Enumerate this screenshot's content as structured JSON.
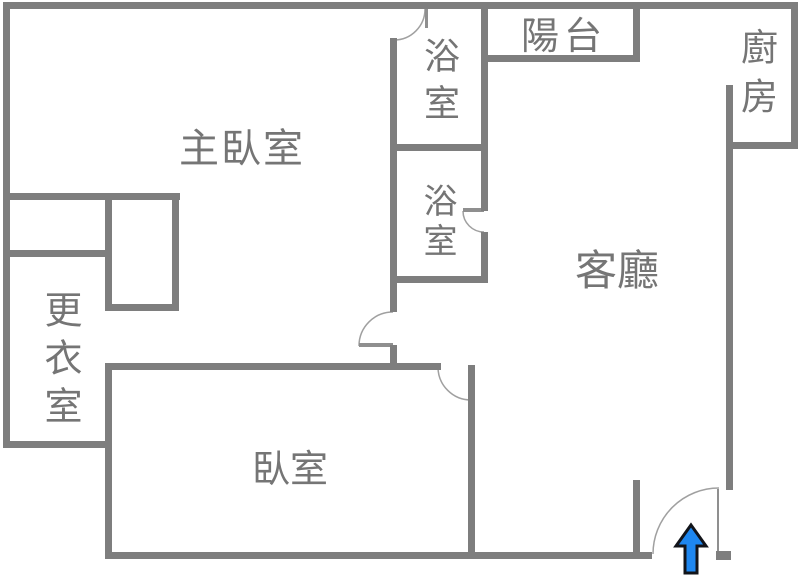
{
  "title": "apartment-floor-plan",
  "canvas": {
    "width": 800,
    "height": 576
  },
  "colors": {
    "background": "#ffffff",
    "wall": "#7e7e7e",
    "label": "#757575",
    "door_arc": "#a0a0a0",
    "door_leaf": "#8f8f8f",
    "arrow_fill": "#1e87f0",
    "arrow_stroke": "#12141a"
  },
  "rooms": [
    {
      "name": "master-bedroom",
      "text": "主臥室",
      "x": 242,
      "y": 149,
      "orientation": "horizontal",
      "font_size": 40,
      "letter_spacing": 2
    },
    {
      "name": "bathroom-top",
      "text": "浴室",
      "x": 438,
      "y": 84,
      "orientation": "vertical",
      "font_size": 36,
      "letter_spacing": 11
    },
    {
      "name": "bathroom-mid",
      "text": "浴室",
      "x": 437,
      "y": 223,
      "orientation": "vertical",
      "font_size": 34,
      "letter_spacing": 6
    },
    {
      "name": "balcony",
      "text": "陽台",
      "x": 564,
      "y": 36,
      "orientation": "horizontal",
      "font_size": 38,
      "letter_spacing": 5
    },
    {
      "name": "kitchen",
      "text": "廚房",
      "x": 756,
      "y": 77,
      "orientation": "vertical",
      "font_size": 37,
      "letter_spacing": 12
    },
    {
      "name": "living-room",
      "text": "客廳",
      "x": 617,
      "y": 271,
      "orientation": "horizontal",
      "font_size": 42,
      "letter_spacing": 0
    },
    {
      "name": "dressing-room",
      "text": "更衣室",
      "x": 60,
      "y": 362,
      "orientation": "vertical",
      "font_size": 38,
      "letter_spacing": 10
    },
    {
      "name": "bedroom",
      "text": "臥室",
      "x": 290,
      "y": 469,
      "orientation": "horizontal",
      "font_size": 38,
      "letter_spacing": 0
    }
  ],
  "walls": [
    {
      "name": "outer-top",
      "x": 3,
      "y": 2,
      "w": 795,
      "h": 7
    },
    {
      "name": "outer-left",
      "x": 3,
      "y": 2,
      "w": 7,
      "h": 446
    },
    {
      "name": "outer-right",
      "x": 791,
      "y": 2,
      "w": 7,
      "h": 147
    },
    {
      "name": "kitchen-bottom",
      "x": 726,
      "y": 142,
      "w": 72,
      "h": 7
    },
    {
      "name": "kitchen-left-long",
      "x": 726,
      "y": 85,
      "w": 7,
      "h": 405
    },
    {
      "name": "bath-right-upper",
      "x": 481,
      "y": 2,
      "w": 7,
      "h": 209
    },
    {
      "name": "bath-right-lower",
      "x": 481,
      "y": 232,
      "w": 7,
      "h": 51
    },
    {
      "name": "balcony-bottom",
      "x": 481,
      "y": 55,
      "w": 159,
      "h": 7
    },
    {
      "name": "balcony-right",
      "x": 633,
      "y": 2,
      "w": 7,
      "h": 60
    },
    {
      "name": "bath-divider",
      "x": 390,
      "y": 144,
      "w": 98,
      "h": 7
    },
    {
      "name": "bath-left",
      "x": 390,
      "y": 38,
      "w": 7,
      "h": 274
    },
    {
      "name": "corridor-stub",
      "x": 390,
      "y": 345,
      "w": 7,
      "h": 25
    },
    {
      "name": "bath-mid-bottom",
      "x": 390,
      "y": 276,
      "w": 98,
      "h": 7
    },
    {
      "name": "bedroom-top",
      "x": 105,
      "y": 363,
      "w": 336,
      "h": 7
    },
    {
      "name": "bedroom-left",
      "x": 105,
      "y": 363,
      "w": 7,
      "h": 196
    },
    {
      "name": "bedroom-right",
      "x": 468,
      "y": 365,
      "w": 7,
      "h": 194
    },
    {
      "name": "outer-bottom",
      "x": 105,
      "y": 552,
      "w": 547,
      "h": 7
    },
    {
      "name": "entry-stub",
      "x": 633,
      "y": 480,
      "w": 7,
      "h": 79
    },
    {
      "name": "entry-jamb",
      "x": 716,
      "y": 551,
      "w": 15,
      "h": 9
    },
    {
      "name": "master-divider",
      "x": 3,
      "y": 193,
      "w": 177,
      "h": 7
    },
    {
      "name": "closet-mid",
      "x": 105,
      "y": 193,
      "w": 7,
      "h": 118
    },
    {
      "name": "closet-right",
      "x": 172,
      "y": 193,
      "w": 7,
      "h": 118
    },
    {
      "name": "closet-shelf",
      "x": 3,
      "y": 250,
      "w": 109,
      "h": 7
    },
    {
      "name": "closet-bottom",
      "x": 105,
      "y": 304,
      "w": 74,
      "h": 7
    },
    {
      "name": "dressing-bottom",
      "x": 3,
      "y": 441,
      "w": 109,
      "h": 7
    }
  ],
  "doors": [
    {
      "name": "door-bathroom-top",
      "arc": "M425,9 A31,31 0 0 1 394,40",
      "leaf": {
        "x": 425,
        "y": 9,
        "w": 3,
        "h": 19
      }
    },
    {
      "name": "door-bathroom-mid",
      "arc": "M463,211 A21,21 0 0 0 484,232",
      "leaf": {
        "x": 463,
        "y": 208,
        "w": 21,
        "h": 4
      }
    },
    {
      "name": "door-master-suite",
      "arc": "M359,346 A34,34 0 0 1 393,312",
      "leaf": {
        "x": 359,
        "y": 343,
        "w": 34,
        "h": 4
      }
    },
    {
      "name": "door-bedroom",
      "arc": "M438,367 A33,33 0 0 0 471,400",
      "leaf": null
    },
    {
      "name": "door-entrance",
      "arc": "M653,554 A66,66 0 0 1 719,488",
      "leaf": {
        "x": 717,
        "y": 489,
        "w": 2,
        "h": 63
      }
    }
  ],
  "entrance_arrow": {
    "name": "entrance-arrow",
    "points": "691,525 706,546 697,546 697,573 685,573 685,546 676,546",
    "stroke_width": 3
  }
}
